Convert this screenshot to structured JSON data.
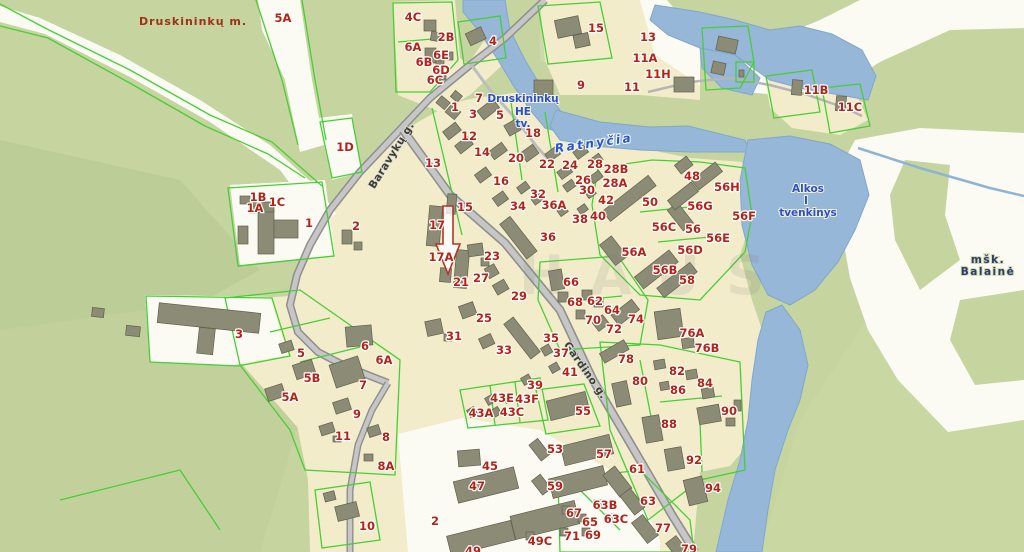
{
  "map": {
    "colors": {
      "base_green": "#c6d4a0",
      "light_green": "#d2dfb0",
      "dark_green": "#bccd97",
      "sand": "#fbfbf4",
      "beige": "#f3ecca",
      "water": "#96b7d7",
      "water_edge": "#7fa8cc",
      "road_fill": "#c6c6c6",
      "road_casing": "#8f8f8f",
      "parcel_line": "#46cf35",
      "building": "#8c8c76",
      "building_stroke": "#60604c",
      "label_red": "#b22418",
      "label_blue": "#2a50c8",
      "label_navy": "#2f3a6e",
      "arrow_outline": "#b0372b"
    },
    "city_label": {
      "text": "Druskininkų m.",
      "x": 193,
      "y": 21
    },
    "street_labels": [
      {
        "text": "Baravykų g.",
        "x": 391,
        "y": 155,
        "rot": -58
      },
      {
        "text": "Gardino g.",
        "x": 586,
        "y": 370,
        "rot": 55
      }
    ],
    "water_name_labels": [
      {
        "text": "Ratnyčia",
        "x": 594,
        "y": 143,
        "rot": -8
      }
    ],
    "hydro_labels": [
      {
        "text": "Druskininkų",
        "x": 523,
        "y": 98
      },
      {
        "text": "HE",
        "x": 523,
        "y": 111
      },
      {
        "text": "tv.",
        "x": 523,
        "y": 123
      },
      {
        "text": "Alkos",
        "x": 808,
        "y": 188
      },
      {
        "text": "I",
        "x": 806,
        "y": 200
      },
      {
        "text": "tvenkinys",
        "x": 808,
        "y": 212
      }
    ],
    "forest_labels": [
      {
        "text": "mšk.",
        "x": 988,
        "y": 259
      },
      {
        "text": "Balainė",
        "x": 988,
        "y": 271
      }
    ],
    "watermark": {
      "text": "HAUS",
      "x": 655,
      "y": 290
    },
    "parcel_labels": [
      {
        "t": "5A",
        "x": 283,
        "y": 18
      },
      {
        "t": "4C",
        "x": 413,
        "y": 17
      },
      {
        "t": "2B",
        "x": 446,
        "y": 37
      },
      {
        "t": "6A",
        "x": 413,
        "y": 47
      },
      {
        "t": "6E",
        "x": 441,
        "y": 55
      },
      {
        "t": "6B",
        "x": 424,
        "y": 62
      },
      {
        "t": "6D",
        "x": 441,
        "y": 70
      },
      {
        "t": "6C",
        "x": 435,
        "y": 80
      },
      {
        "t": "4",
        "x": 493,
        "y": 41
      },
      {
        "t": "15",
        "x": 596,
        "y": 28
      },
      {
        "t": "13",
        "x": 648,
        "y": 37
      },
      {
        "t": "11A",
        "x": 645,
        "y": 58
      },
      {
        "t": "11H",
        "x": 658,
        "y": 74
      },
      {
        "t": "11",
        "x": 632,
        "y": 87
      },
      {
        "t": "9",
        "x": 581,
        "y": 85
      },
      {
        "t": "11B",
        "x": 816,
        "y": 90
      },
      {
        "t": "11C",
        "x": 850,
        "y": 107
      },
      {
        "t": "1D",
        "x": 345,
        "y": 147
      },
      {
        "t": "7",
        "x": 479,
        "y": 98
      },
      {
        "t": "1",
        "x": 455,
        "y": 107
      },
      {
        "t": "3",
        "x": 473,
        "y": 114
      },
      {
        "t": "5",
        "x": 500,
        "y": 115
      },
      {
        "t": "12",
        "x": 469,
        "y": 136
      },
      {
        "t": "18",
        "x": 533,
        "y": 133
      },
      {
        "t": "14",
        "x": 482,
        "y": 152
      },
      {
        "t": "13",
        "x": 433,
        "y": 163
      },
      {
        "t": "20",
        "x": 516,
        "y": 158
      },
      {
        "t": "16",
        "x": 501,
        "y": 181
      },
      {
        "t": "22",
        "x": 547,
        "y": 164
      },
      {
        "t": "24",
        "x": 570,
        "y": 165
      },
      {
        "t": "26",
        "x": 583,
        "y": 180
      },
      {
        "t": "28",
        "x": 595,
        "y": 164
      },
      {
        "t": "28B",
        "x": 616,
        "y": 169
      },
      {
        "t": "28A",
        "x": 615,
        "y": 183
      },
      {
        "t": "30",
        "x": 587,
        "y": 190
      },
      {
        "t": "32",
        "x": 538,
        "y": 194
      },
      {
        "t": "34",
        "x": 518,
        "y": 206
      },
      {
        "t": "36A",
        "x": 554,
        "y": 205
      },
      {
        "t": "38",
        "x": 580,
        "y": 219
      },
      {
        "t": "40",
        "x": 598,
        "y": 216
      },
      {
        "t": "42",
        "x": 606,
        "y": 200
      },
      {
        "t": "48",
        "x": 692,
        "y": 176
      },
      {
        "t": "50",
        "x": 650,
        "y": 202
      },
      {
        "t": "15",
        "x": 465,
        "y": 207
      },
      {
        "t": "17",
        "x": 437,
        "y": 225
      },
      {
        "t": "1B",
        "x": 258,
        "y": 197
      },
      {
        "t": "1A",
        "x": 255,
        "y": 208
      },
      {
        "t": "1C",
        "x": 277,
        "y": 202
      },
      {
        "t": "1",
        "x": 309,
        "y": 223
      },
      {
        "t": "2",
        "x": 356,
        "y": 226
      },
      {
        "t": "56H",
        "x": 727,
        "y": 187
      },
      {
        "t": "56G",
        "x": 700,
        "y": 206
      },
      {
        "t": "56F",
        "x": 744,
        "y": 216
      },
      {
        "t": "56C",
        "x": 664,
        "y": 227
      },
      {
        "t": "56",
        "x": 693,
        "y": 229
      },
      {
        "t": "56E",
        "x": 718,
        "y": 238
      },
      {
        "t": "56A",
        "x": 634,
        "y": 252
      },
      {
        "t": "56D",
        "x": 690,
        "y": 250
      },
      {
        "t": "56B",
        "x": 665,
        "y": 270
      },
      {
        "t": "58",
        "x": 687,
        "y": 280
      },
      {
        "t": "17A",
        "x": 441,
        "y": 257
      },
      {
        "t": "23",
        "x": 492,
        "y": 256
      },
      {
        "t": "21",
        "x": 461,
        "y": 282
      },
      {
        "t": "27",
        "x": 481,
        "y": 278
      },
      {
        "t": "29",
        "x": 519,
        "y": 296
      },
      {
        "t": "25",
        "x": 484,
        "y": 318
      },
      {
        "t": "31",
        "x": 454,
        "y": 336
      },
      {
        "t": "33",
        "x": 504,
        "y": 350
      },
      {
        "t": "36",
        "x": 548,
        "y": 237
      },
      {
        "t": "35",
        "x": 551,
        "y": 338
      },
      {
        "t": "37",
        "x": 561,
        "y": 353
      },
      {
        "t": "41",
        "x": 570,
        "y": 372
      },
      {
        "t": "39",
        "x": 535,
        "y": 385
      },
      {
        "t": "66",
        "x": 571,
        "y": 282
      },
      {
        "t": "68",
        "x": 575,
        "y": 302
      },
      {
        "t": "62",
        "x": 595,
        "y": 301
      },
      {
        "t": "64",
        "x": 612,
        "y": 310
      },
      {
        "t": "70",
        "x": 593,
        "y": 320
      },
      {
        "t": "72",
        "x": 614,
        "y": 329
      },
      {
        "t": "74",
        "x": 636,
        "y": 319
      },
      {
        "t": "76A",
        "x": 692,
        "y": 333
      },
      {
        "t": "76B",
        "x": 707,
        "y": 348
      },
      {
        "t": "78",
        "x": 626,
        "y": 359
      },
      {
        "t": "80",
        "x": 640,
        "y": 381
      },
      {
        "t": "82",
        "x": 677,
        "y": 371
      },
      {
        "t": "84",
        "x": 705,
        "y": 383
      },
      {
        "t": "86",
        "x": 678,
        "y": 390
      },
      {
        "t": "88",
        "x": 669,
        "y": 424
      },
      {
        "t": "90",
        "x": 729,
        "y": 411
      },
      {
        "t": "92",
        "x": 694,
        "y": 460
      },
      {
        "t": "94",
        "x": 713,
        "y": 488
      },
      {
        "t": "3",
        "x": 239,
        "y": 334
      },
      {
        "t": "5",
        "x": 301,
        "y": 353
      },
      {
        "t": "6",
        "x": 365,
        "y": 346
      },
      {
        "t": "6A",
        "x": 384,
        "y": 360
      },
      {
        "t": "5B",
        "x": 312,
        "y": 378
      },
      {
        "t": "7",
        "x": 363,
        "y": 385
      },
      {
        "t": "5A",
        "x": 290,
        "y": 397
      },
      {
        "t": "9",
        "x": 357,
        "y": 414
      },
      {
        "t": "11",
        "x": 343,
        "y": 436
      },
      {
        "t": "8",
        "x": 386,
        "y": 437
      },
      {
        "t": "8A",
        "x": 386,
        "y": 466
      },
      {
        "t": "10",
        "x": 367,
        "y": 526
      },
      {
        "t": "43E",
        "x": 502,
        "y": 398
      },
      {
        "t": "43F",
        "x": 527,
        "y": 399
      },
      {
        "t": "43A",
        "x": 481,
        "y": 413
      },
      {
        "t": "43C",
        "x": 512,
        "y": 412
      },
      {
        "t": "45",
        "x": 490,
        "y": 466
      },
      {
        "t": "47",
        "x": 477,
        "y": 486
      },
      {
        "t": "2",
        "x": 435,
        "y": 521
      },
      {
        "t": "49",
        "x": 473,
        "y": 551
      },
      {
        "t": "55",
        "x": 583,
        "y": 411
      },
      {
        "t": "53",
        "x": 555,
        "y": 449
      },
      {
        "t": "57",
        "x": 604,
        "y": 454
      },
      {
        "t": "61",
        "x": 637,
        "y": 469
      },
      {
        "t": "59",
        "x": 555,
        "y": 486
      },
      {
        "t": "63B",
        "x": 605,
        "y": 505
      },
      {
        "t": "63",
        "x": 648,
        "y": 501
      },
      {
        "t": "63C",
        "x": 616,
        "y": 519
      },
      {
        "t": "67",
        "x": 574,
        "y": 513
      },
      {
        "t": "65",
        "x": 590,
        "y": 522
      },
      {
        "t": "69",
        "x": 593,
        "y": 535
      },
      {
        "t": "71",
        "x": 572,
        "y": 536
      },
      {
        "t": "77",
        "x": 663,
        "y": 528
      },
      {
        "t": "79",
        "x": 689,
        "y": 549
      },
      {
        "t": "49C",
        "x": 540,
        "y": 541
      }
    ]
  }
}
